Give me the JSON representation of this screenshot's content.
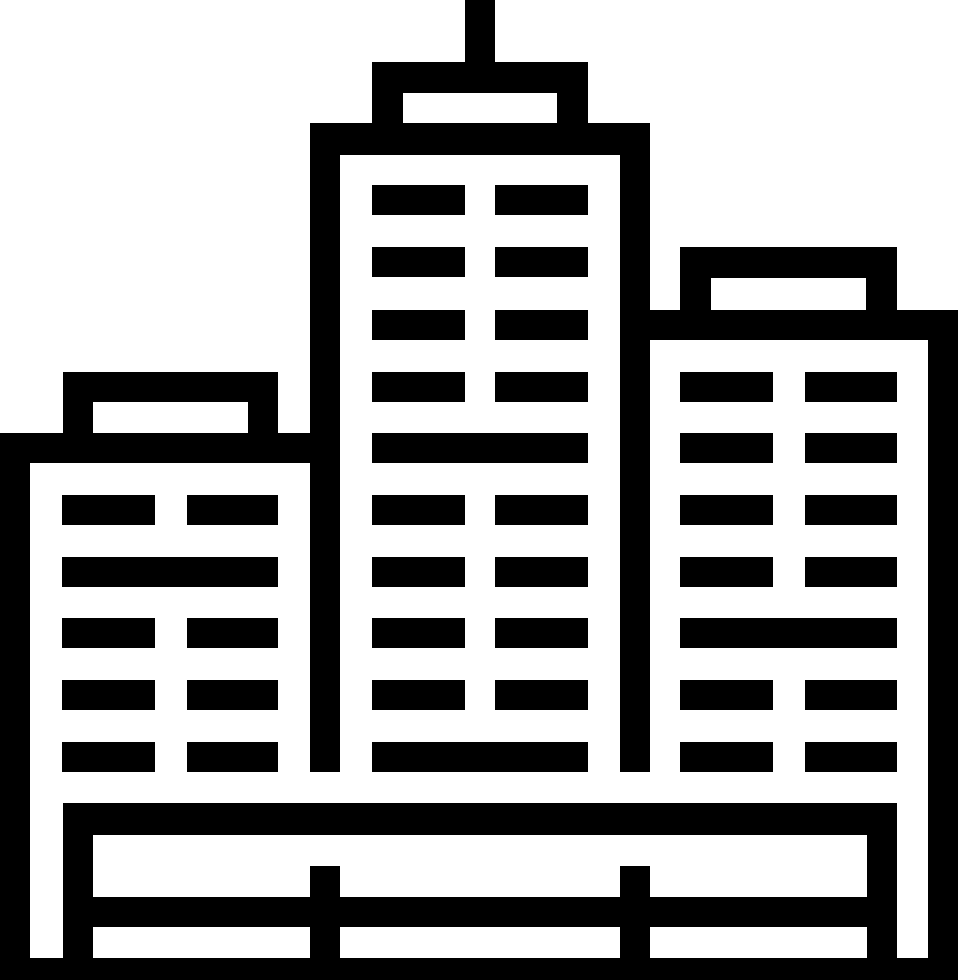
{
  "icon": {
    "name": "city-buildings-icon",
    "description": "Black outline pictogram of a city skyline: three high-rise buildings with horizontal window slats, a rooftop antenna on the tallest central tower, and a fenced base platform",
    "foreground": "#000000",
    "background": "#ffffff",
    "canvas": {
      "width": 960,
      "height": 980
    },
    "parts": [
      {
        "name": "antenna",
        "rects": [
          [
            465,
            0,
            30,
            62
          ]
        ]
      },
      {
        "name": "center-building-cap",
        "rects": [
          [
            372,
            62,
            216,
            31
          ],
          [
            372,
            93,
            31,
            30
          ],
          [
            557,
            93,
            31,
            30
          ]
        ]
      },
      {
        "name": "center-building-roof",
        "rects": [
          [
            310,
            123,
            340,
            32
          ]
        ]
      },
      {
        "name": "center-building-walls",
        "rects": [
          [
            310,
            155,
            30,
            617
          ],
          [
            620,
            155,
            30,
            617
          ]
        ]
      },
      {
        "name": "center-building-windows",
        "rects": [
          [
            372,
            185,
            93,
            30
          ],
          [
            495,
            185,
            93,
            30
          ],
          [
            372,
            247,
            93,
            30
          ],
          [
            495,
            247,
            93,
            30
          ],
          [
            372,
            310,
            93,
            30
          ],
          [
            495,
            310,
            93,
            30
          ],
          [
            372,
            372,
            93,
            30
          ],
          [
            495,
            372,
            93,
            30
          ],
          [
            372,
            433,
            216,
            30
          ],
          [
            372,
            495,
            93,
            30
          ],
          [
            495,
            495,
            93,
            30
          ],
          [
            372,
            557,
            93,
            30
          ],
          [
            495,
            557,
            93,
            30
          ],
          [
            372,
            618,
            93,
            30
          ],
          [
            495,
            618,
            93,
            30
          ],
          [
            372,
            680,
            93,
            30
          ],
          [
            495,
            680,
            93,
            30
          ],
          [
            372,
            742,
            216,
            30
          ]
        ]
      },
      {
        "name": "left-building-cap",
        "rects": [
          [
            63,
            372,
            215,
            30
          ],
          [
            63,
            402,
            30,
            31
          ],
          [
            248,
            402,
            30,
            31
          ]
        ]
      },
      {
        "name": "left-building-roof",
        "rects": [
          [
            0,
            433,
            310,
            30
          ]
        ]
      },
      {
        "name": "left-building-wall",
        "rects": [
          [
            0,
            463,
            30,
            517
          ]
        ]
      },
      {
        "name": "left-building-windows",
        "rects": [
          [
            62,
            495,
            93,
            30
          ],
          [
            187,
            495,
            91,
            30
          ],
          [
            62,
            557,
            216,
            30
          ],
          [
            62,
            618,
            93,
            30
          ],
          [
            187,
            618,
            91,
            30
          ],
          [
            62,
            680,
            93,
            30
          ],
          [
            187,
            680,
            91,
            30
          ],
          [
            62,
            742,
            93,
            30
          ],
          [
            187,
            742,
            91,
            30
          ]
        ]
      },
      {
        "name": "right-building-cap",
        "rects": [
          [
            680,
            247,
            217,
            31
          ],
          [
            680,
            278,
            31,
            32
          ],
          [
            866,
            278,
            31,
            32
          ]
        ]
      },
      {
        "name": "right-building-roof",
        "rects": [
          [
            620,
            310,
            338,
            30
          ]
        ]
      },
      {
        "name": "right-building-wall",
        "rects": [
          [
            928,
            340,
            30,
            640
          ]
        ]
      },
      {
        "name": "right-building-windows",
        "rects": [
          [
            680,
            372,
            93,
            30
          ],
          [
            805,
            372,
            92,
            30
          ],
          [
            680,
            433,
            93,
            30
          ],
          [
            805,
            433,
            92,
            30
          ],
          [
            680,
            495,
            93,
            30
          ],
          [
            805,
            495,
            92,
            30
          ],
          [
            680,
            557,
            93,
            30
          ],
          [
            805,
            557,
            92,
            30
          ],
          [
            680,
            618,
            217,
            30
          ],
          [
            680,
            680,
            93,
            30
          ],
          [
            805,
            680,
            92,
            30
          ],
          [
            680,
            742,
            93,
            30
          ],
          [
            805,
            742,
            92,
            30
          ]
        ]
      },
      {
        "name": "base-platform",
        "rects": [
          [
            63,
            803,
            834,
            32
          ],
          [
            63,
            835,
            30,
            145
          ],
          [
            867,
            835,
            30,
            145
          ],
          [
            63,
            897,
            834,
            30
          ],
          [
            310,
            866,
            30,
            114
          ],
          [
            620,
            866,
            30,
            114
          ],
          [
            0,
            958,
            958,
            22
          ]
        ]
      }
    ]
  }
}
